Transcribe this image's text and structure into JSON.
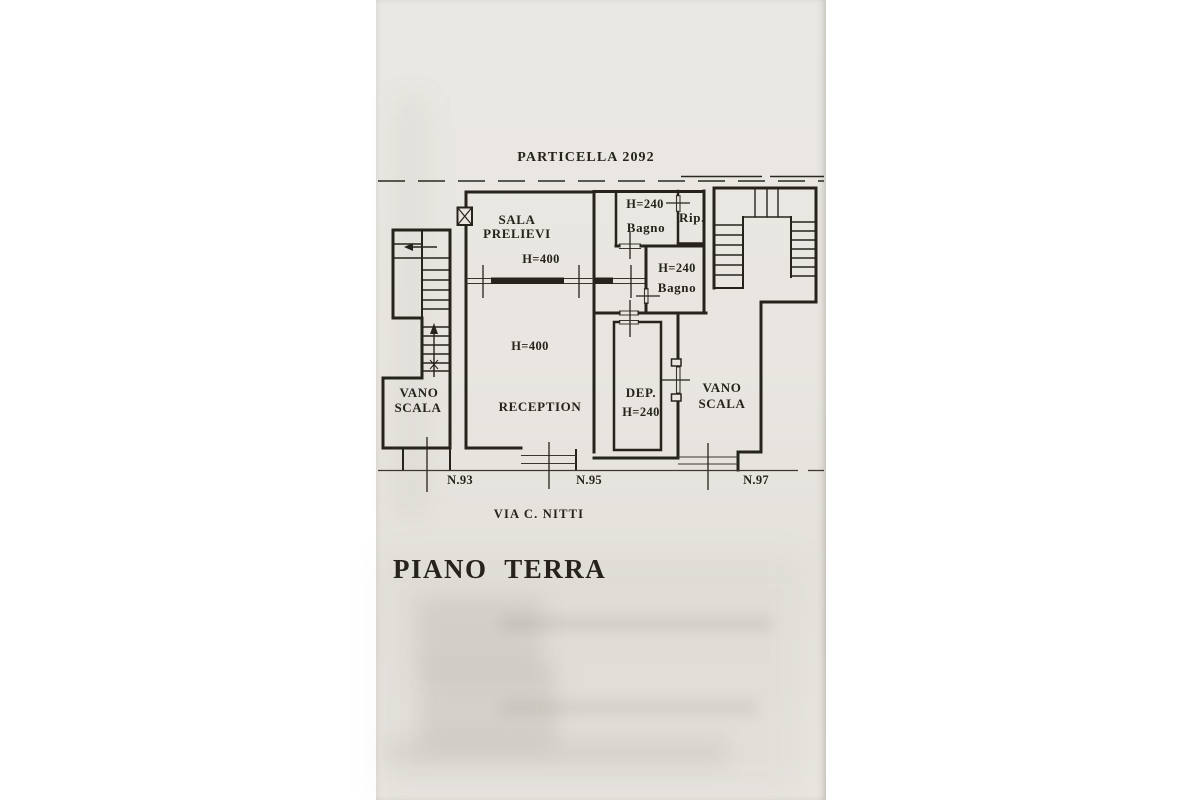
{
  "document": {
    "plan_title": "PIANO  TERRA",
    "parcel_label": "PARTICELLA 2092",
    "street_name": "VIA C. NITTI"
  },
  "rooms": {
    "sala_prelievi": {
      "line1": "SALA",
      "line2": "PRELIEVI",
      "height": "H=400"
    },
    "reception": {
      "name": "RECEPTION",
      "height": "H=400"
    },
    "bagno_top": {
      "height": "H=240",
      "name": "Bagno"
    },
    "ripostiglio": {
      "name": "Rip."
    },
    "bagno_mid": {
      "height": "H=240",
      "name": "Bagno"
    },
    "deposito": {
      "name": "DEP.",
      "height": "H=240"
    },
    "vano_scala_left": {
      "line1": "VANO",
      "line2": "SCALA"
    },
    "vano_scala_right": {
      "line1": "VANO",
      "line2": "SCALA"
    }
  },
  "street_numbers": [
    {
      "label": "N.93"
    },
    {
      "label": "N.95"
    },
    {
      "label": "N.97"
    }
  ],
  "colors": {
    "ink": "#26231d",
    "paper": "#e9e6e1",
    "page_background": "#ffffff"
  }
}
